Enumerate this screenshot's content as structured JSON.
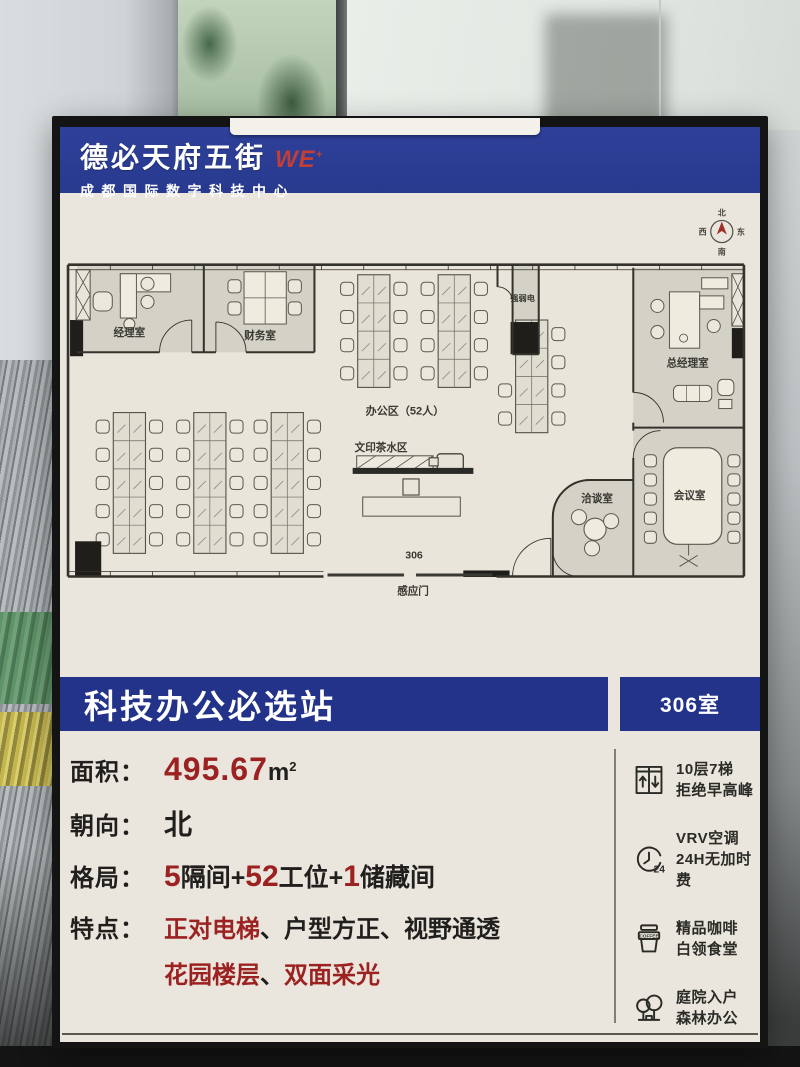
{
  "header": {
    "brand": "德必天府五街",
    "brand_we": "WE",
    "brand_sup": "+",
    "subtitle": "成都国际数字科技中心"
  },
  "plan": {
    "compass": {
      "n": "北",
      "e": "东",
      "s": "南",
      "w": "西"
    },
    "manager": "经理室",
    "finance": "财务室",
    "power": "强弱电",
    "gm": "总经理室",
    "chat": "洽谈室",
    "conference": "会议室",
    "office": "办公区（52人）",
    "print": "文印茶水区",
    "unit": "306",
    "door": "感应门"
  },
  "banner": {
    "title": "科技办公必选站",
    "room": "306室"
  },
  "specs": {
    "area": {
      "label": "面积：",
      "value": "495.67",
      "unit": "m",
      "sup": "2"
    },
    "facing": {
      "label": "朝向：",
      "value": "北"
    },
    "layout": {
      "label": "格局：",
      "n1": "5",
      "t1": "隔间+",
      "n2": "52",
      "t2": "工位+",
      "n3": "1",
      "t3": "储藏间"
    },
    "features": {
      "label": "特点：",
      "f1": "正对电梯",
      "s1": "、",
      "f2": "户型方正",
      "s2": "、",
      "f3": "视野通透",
      "f4": "花园楼层",
      "s3": "、",
      "f5": "双面采光"
    }
  },
  "amenities": [
    {
      "line1": "10层7梯",
      "line2": "拒绝早高峰"
    },
    {
      "line1": "VRV空调",
      "line2": "24H无加时费"
    },
    {
      "line1": "精品咖啡",
      "line2": "白领食堂"
    },
    {
      "line1": "庭院入户",
      "line2": "森林办公"
    }
  ],
  "icons": {
    "clock_badge": "24",
    "coffee_band": "COFFEE"
  },
  "colors": {
    "header_blue": "#2a3a8f",
    "banner_blue": "#23338a",
    "accent_red": "#9c2121"
  }
}
